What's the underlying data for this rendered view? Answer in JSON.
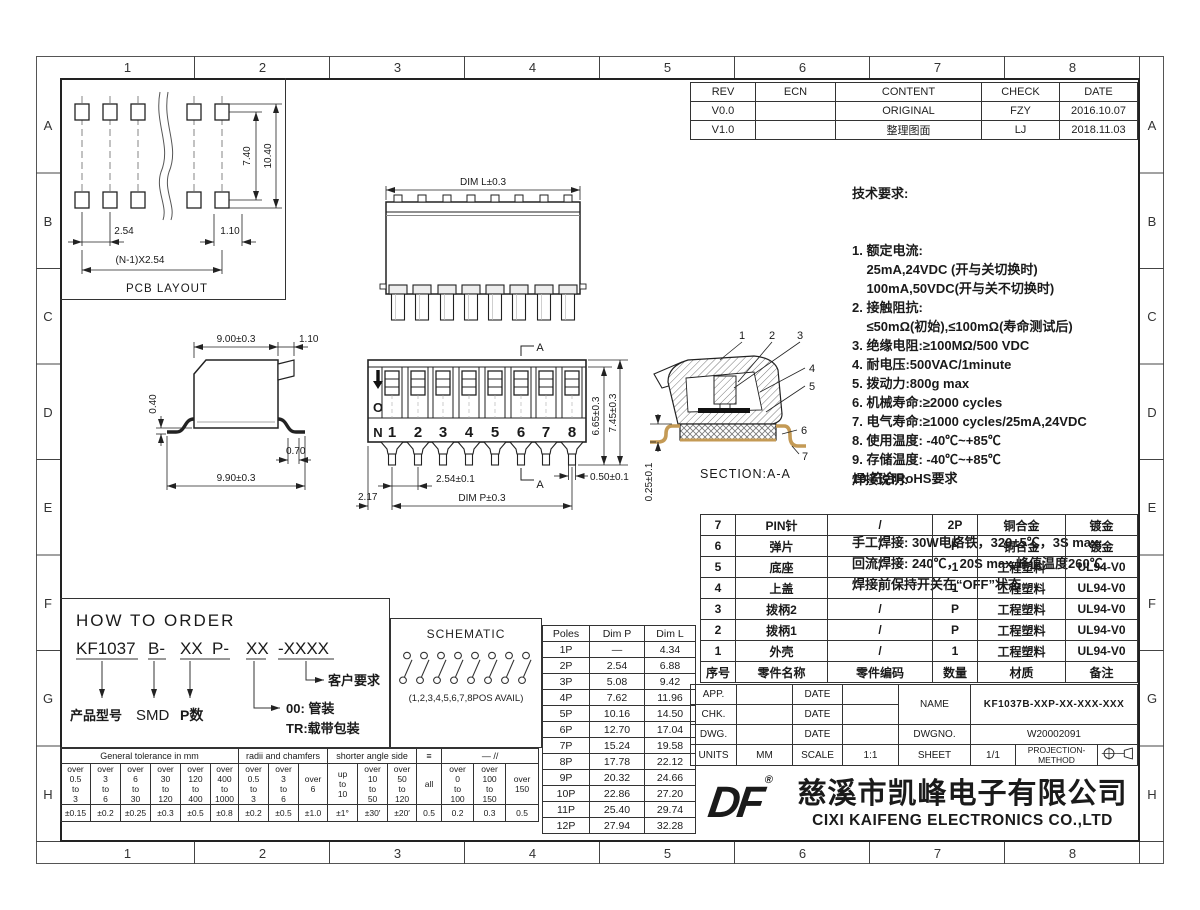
{
  "sheet": {
    "grid_cols": [
      "1",
      "2",
      "3",
      "4",
      "5",
      "6",
      "7",
      "8"
    ],
    "grid_rows": [
      "A",
      "B",
      "C",
      "D",
      "E",
      "F",
      "G",
      "H"
    ]
  },
  "revision_table": {
    "headers": [
      "REV",
      "ECN",
      "CONTENT",
      "CHECK",
      "DATE"
    ],
    "rows": [
      [
        "V0.0",
        "",
        "ORIGINAL",
        "FZY",
        "2016.10.07"
      ],
      [
        "V1.0",
        "",
        "整理图面",
        "LJ",
        "2018.11.03"
      ]
    ]
  },
  "tech_requirements": {
    "title": "技术要求:",
    "lines": [
      "1. 额定电流:",
      "    25mA,24VDC (开与关切换时)",
      "    100mA,50VDC(开与关不切换时)",
      "2. 接触阻抗:",
      "    ≤50mΩ(初始),≤100mΩ(寿命测试后)",
      "3. 绝缘电阻:≥100MΩ/500 VDC",
      "4. 耐电压:500VAC/1minute",
      "5. 拨动力:800g max",
      "6. 机械寿命:≥2000 cycles",
      "7. 电气寿命:≥1000 cycles/25mA,24VDC",
      "8. 使用温度: -40℃~+85℃",
      "9. 存储温度: -40℃~+85℃",
      "10.符合RoHS要求"
    ]
  },
  "solder_notes": {
    "title": "焊接说明:",
    "lines": [
      "手工焊接: 30W电烙铁，320±5℃，3S max;",
      "回流焊接: 240℃，20S max,峰值温度260℃,",
      "焊接前保持开关在“OFF”状态"
    ]
  },
  "bom_table": {
    "headers": [
      "序号",
      "零件名称",
      "零件编码",
      "数量",
      "材质",
      "备注"
    ],
    "rows": [
      [
        "7",
        "PIN针",
        "/",
        "2P",
        "铜合金",
        "镀金"
      ],
      [
        "6",
        "弹片",
        "/",
        "P",
        "铜合金",
        "镀金"
      ],
      [
        "5",
        "底座",
        "/",
        "1",
        "工程塑料",
        "UL94-V0"
      ],
      [
        "4",
        "上盖",
        "/",
        "1",
        "工程塑料",
        "UL94-V0"
      ],
      [
        "3",
        "拨柄2",
        "/",
        "P",
        "工程塑料",
        "UL94-V0"
      ],
      [
        "2",
        "拨柄1",
        "/",
        "P",
        "工程塑料",
        "UL94-V0"
      ],
      [
        "1",
        "外壳",
        "/",
        "1",
        "工程塑料",
        "UL94-V0"
      ]
    ]
  },
  "poles_table": {
    "headers": [
      "Poles",
      "Dim P",
      "Dim L"
    ],
    "rows": [
      [
        "1P",
        "—",
        "4.34"
      ],
      [
        "2P",
        "2.54",
        "6.88"
      ],
      [
        "3P",
        "5.08",
        "9.42"
      ],
      [
        "4P",
        "7.62",
        "11.96"
      ],
      [
        "5P",
        "10.16",
        "14.50"
      ],
      [
        "6P",
        "12.70",
        "17.04"
      ],
      [
        "7P",
        "15.24",
        "19.58"
      ],
      [
        "8P",
        "17.78",
        "22.12"
      ],
      [
        "9P",
        "20.32",
        "24.66"
      ],
      [
        "10P",
        "22.86",
        "27.20"
      ],
      [
        "11P",
        "25.40",
        "29.74"
      ],
      [
        "12P",
        "27.94",
        "32.28"
      ]
    ]
  },
  "tolerance_table": {
    "group_headers": [
      "General tolerance in mm",
      "radii and chamfers",
      "shorter angle side",
      "≡",
      "—  //"
    ],
    "ranges": [
      "over\n0.5\nto\n3",
      "over\n3\nto\n6",
      "over\n6\nto\n30",
      "over\n30\nto\n120",
      "over\n120\nto\n400",
      "over\n400\nto\n1000",
      "over\n0.5\nto\n3",
      "over\n3\nto\n6",
      "over\n6",
      "up\nto\n10",
      "over\n10\nto\n50",
      "over\n50\nto\n120",
      "all",
      "over\n0\nto\n100",
      "over\n100\nto\n150",
      "over\n150"
    ],
    "values": [
      "±0.15",
      "±0.2",
      "±0.25",
      "±0.3",
      "±0.5",
      "±0.8",
      "±0.2",
      "±0.5",
      "±1.0",
      "±1°",
      "±30′",
      "±20′",
      "0.5",
      "0.2",
      "0.3",
      "0.5"
    ]
  },
  "how_to_order": {
    "title": "HOW TO ORDER",
    "segments": [
      "KF1037",
      "B-",
      "XX",
      "P-",
      "XX",
      "-XXXX"
    ],
    "labels": {
      "product": "产品型号",
      "smd": "SMD",
      "poles": "P数",
      "pkg_tube": "00: 管装",
      "pkg_tape": "TR:载带包装",
      "customer": "客户要求"
    }
  },
  "schematic": {
    "title": "SCHEMATIC",
    "caption": "(1,2,3,4,5,6,7,8POS AVAIL)"
  },
  "views": {
    "pcb": {
      "label": "PCB LAYOUT",
      "dim_v1": "7.40",
      "dim_v2": "10.40",
      "dim_h1": "2.54",
      "dim_h2": "1.10",
      "dim_h3": "(N-1)X2.54"
    },
    "top": {
      "dim_l": "DIM L±0.3"
    },
    "side": {
      "dim_top": "9.00±0.3",
      "dim_top2": "1.10",
      "dim_left": "0.40",
      "dim_foot": "0.70",
      "dim_bottom": "9.90±0.3"
    },
    "front": {
      "on_letters": [
        "O",
        "N"
      ],
      "positions": [
        "1",
        "2",
        "3",
        "4",
        "5",
        "6",
        "7",
        "8"
      ],
      "dim_height_inner": "6.65±0.3",
      "dim_height": "7.45±0.3",
      "dim_pin_w": "0.50±0.1",
      "dim_pitch": "2.54±0.1",
      "dim_p": "DIM P±0.3",
      "dim_edge": "2.17",
      "marker": "A"
    },
    "section": {
      "label": "SECTION:A-A",
      "dim_standoff": "0.25±0.1",
      "callouts": [
        "1",
        "2",
        "3",
        "4",
        "5",
        "6",
        "7"
      ]
    }
  },
  "title_block": {
    "app_label": "APP.",
    "chk_label": "CHK.",
    "dwg_label": "DWG.",
    "date_label": "DATE",
    "name_label": "NAME",
    "name_value": "KF1037B-XXP-XX-XXX-XXX",
    "dwgno_label": "DWGNO.",
    "dwgno_value": "W20002091",
    "units_label": "UNITS",
    "units_value": "MM",
    "scale_label": "SCALE",
    "scale_value": "1:1",
    "sheet_label": "SHEET",
    "sheet_value": "1/1",
    "projection_label": "PROJECTION-METHOD"
  },
  "company": {
    "logo_text": "DF",
    "logo_reg": "®",
    "name_cn": "慈溪市凯峰电子有限公司",
    "name_en": "CIXI KAIFENG ELECTRONICS CO.,LTD"
  }
}
